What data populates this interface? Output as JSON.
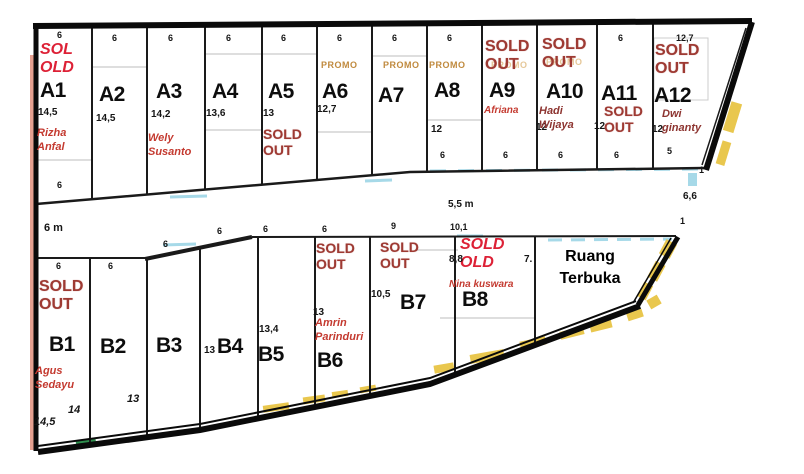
{
  "road": {
    "left_width": "6 m",
    "right_width": "5,5 m"
  },
  "open_space": {
    "name": "Ruang Terbuka"
  },
  "edge_labels": {
    "right_top": "1",
    "right_mid": "6,6",
    "right_bottom": "1"
  },
  "plots_a": [
    {
      "id": "A1",
      "top": "6",
      "status": "SOL OLD",
      "label": "A1",
      "dim": "14,5",
      "name": "Rizha Anfal",
      "bottom": "6"
    },
    {
      "id": "A2",
      "top": "6",
      "label": "A2",
      "dim": "14,5"
    },
    {
      "id": "A3",
      "top": "6",
      "label": "A3",
      "dim": "14,2",
      "name": "Wely Susanto"
    },
    {
      "id": "A4",
      "top": "6",
      "label": "A4",
      "dim": "13,6"
    },
    {
      "id": "A5",
      "top": "6",
      "label": "A5",
      "dim": "13",
      "status": "SOLD OUT"
    },
    {
      "id": "A6",
      "top": "6",
      "promo": "PROMO",
      "label": "A6",
      "dim": "12,7"
    },
    {
      "id": "A7",
      "top": "6",
      "promo": "PROMO",
      "label": "A7"
    },
    {
      "id": "A8",
      "top": "6",
      "promo": "PROMO",
      "label": "A8",
      "dim": "12",
      "bottom": "6"
    },
    {
      "id": "A9",
      "status": "SOLD OUT",
      "ghost": "PROMO",
      "label": "A9",
      "name": "Afriana",
      "bottom": "6"
    },
    {
      "id": "A10",
      "status": "SOLD OUT",
      "ghost": "PROMO",
      "label": "A10",
      "name": "Hadi Wijaya",
      "dim": "12",
      "bottom": "6"
    },
    {
      "id": "A11",
      "top": "6",
      "label": "A11",
      "status": "SOLD OUT",
      "dim": "12",
      "bottom": "6"
    },
    {
      "id": "A12",
      "top": "12,7",
      "status": "SOLD OUT",
      "label": "A12",
      "name": "Dwi ginanty",
      "dim": "12",
      "bottom": "5"
    }
  ],
  "plots_b": [
    {
      "id": "B1",
      "top": "6",
      "status": "SOLD OUT",
      "label": "B1",
      "name": "Agus Sedayu",
      "dim": "14,5"
    },
    {
      "id": "B2",
      "top": "6",
      "label": "B2",
      "dim": "14"
    },
    {
      "id": "B3",
      "top": "6",
      "label": "B3",
      "dim": "13"
    },
    {
      "id": "B4",
      "top": "6",
      "dim": "13",
      "label": "B4"
    },
    {
      "id": "B5",
      "top": "6",
      "dim": "13,4",
      "label": "B5"
    },
    {
      "id": "B6",
      "top": "6",
      "status": "SOLD OUT",
      "dim": "13",
      "name": "Amrin Parinduri",
      "label": "B6"
    },
    {
      "id": "B7",
      "top": "9",
      "status": "SOLD OUT",
      "dim": "10,5",
      "label": "B7"
    },
    {
      "id": "B8",
      "top": "10,1",
      "status": "SOLD OLD",
      "dim": "8,8",
      "name": "Nina kuswara",
      "label": "B8",
      "side": "7."
    }
  ]
}
